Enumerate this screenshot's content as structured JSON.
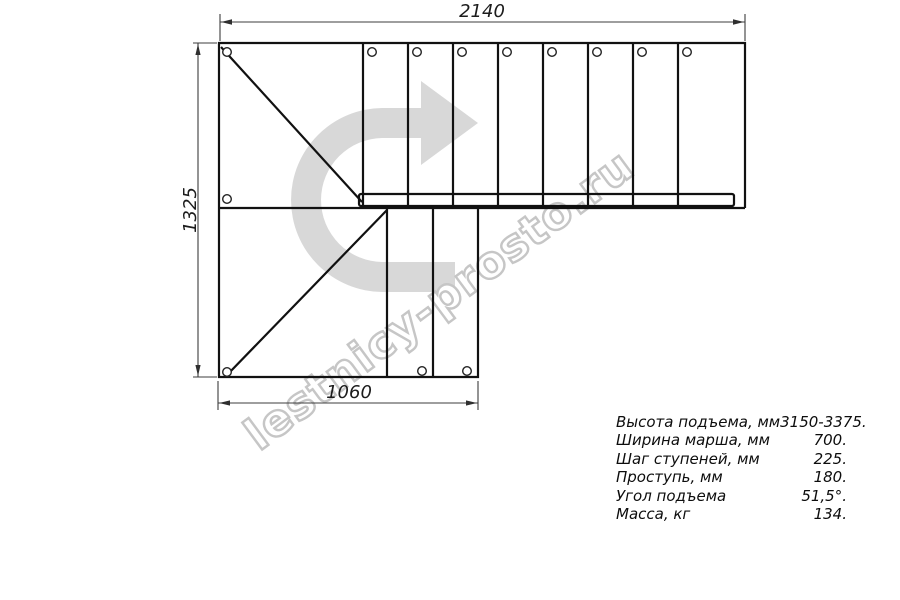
{
  "drawing": {
    "dimensions_mm": {
      "top": "2140",
      "left": "1325",
      "bottom": "1060"
    },
    "watermark": "lestnicy-prosto.ru",
    "direction_arrow": "u-turn-arrow-pointing-right",
    "colors": {
      "background": "#ffffff",
      "line": "#111111",
      "dimension_line": "#3c3c3c",
      "arrow_fill": "#d8d8d8",
      "watermark_outline": "#c6c6c6"
    }
  },
  "specs": {
    "rows": [
      {
        "label": "Высота подъема, мм",
        "value": "3150-3375."
      },
      {
        "label": "Ширина марша, мм",
        "value": "700."
      },
      {
        "label": "Шаг ступеней, мм",
        "value": "225."
      },
      {
        "label": "Проступь, мм",
        "value": "180."
      },
      {
        "label": "Угол подъема",
        "value": "51,5°."
      },
      {
        "label": "Масса, кг",
        "value": "134."
      }
    ]
  }
}
